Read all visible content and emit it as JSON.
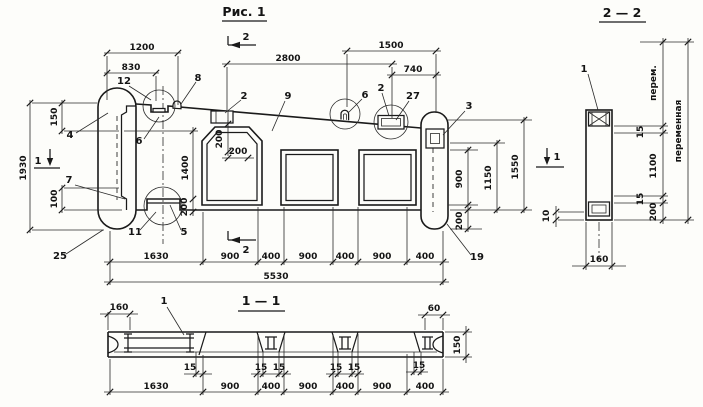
{
  "drawing": {
    "fig_title": "Рис. 1",
    "sec22_title": "2 — 2",
    "sec11_title": "1 — 1"
  },
  "main": {
    "top_dims": {
      "d1200": "1200",
      "d830": "830",
      "d2800": "2800",
      "d1500": "1500",
      "d740": "740"
    },
    "left_dims": {
      "d1930": "1930",
      "d150": "150",
      "d100": "100"
    },
    "mid_dims": {
      "d1400": "1400",
      "d200v": "200",
      "d200h": "200",
      "d200b": "200"
    },
    "right_dims": {
      "d900": "900",
      "d1150": "1150",
      "d1550": "1550",
      "d200": "200"
    },
    "bottom_dims": [
      "1630",
      "900",
      "400",
      "900",
      "400",
      "900",
      "400"
    ],
    "total": "5530",
    "labels": {
      "p4": "4",
      "p12": "12",
      "p6a": "6",
      "p8": "8",
      "p2a": "2",
      "p9": "9",
      "p6b": "6",
      "p2b": "2",
      "p27": "27",
      "p3": "3",
      "p7": "7",
      "p25": "25",
      "p11": "11",
      "p5": "5",
      "p19": "19"
    },
    "markers": {
      "m1_left": "1",
      "m1_right": "1",
      "m2_top": "2",
      "m2_bottom": "2"
    }
  },
  "sec22": {
    "label1": "1",
    "dims": {
      "perem": "перем.",
      "d15a": "15",
      "d1100": "1100",
      "d15b": "15",
      "d200": "200",
      "total": "переменная",
      "d160": "160",
      "d10": "10"
    }
  },
  "sec11": {
    "label1": "1",
    "dims": {
      "d160": "160",
      "d60": "60",
      "d150": "150",
      "d15a": "15",
      "d15b": "15",
      "d15c": "15",
      "d15d": "15",
      "d15e": "15",
      "d15f": "15"
    },
    "bottom_dims": [
      "1630",
      "900",
      "400",
      "900",
      "400",
      "900",
      "400"
    ]
  }
}
